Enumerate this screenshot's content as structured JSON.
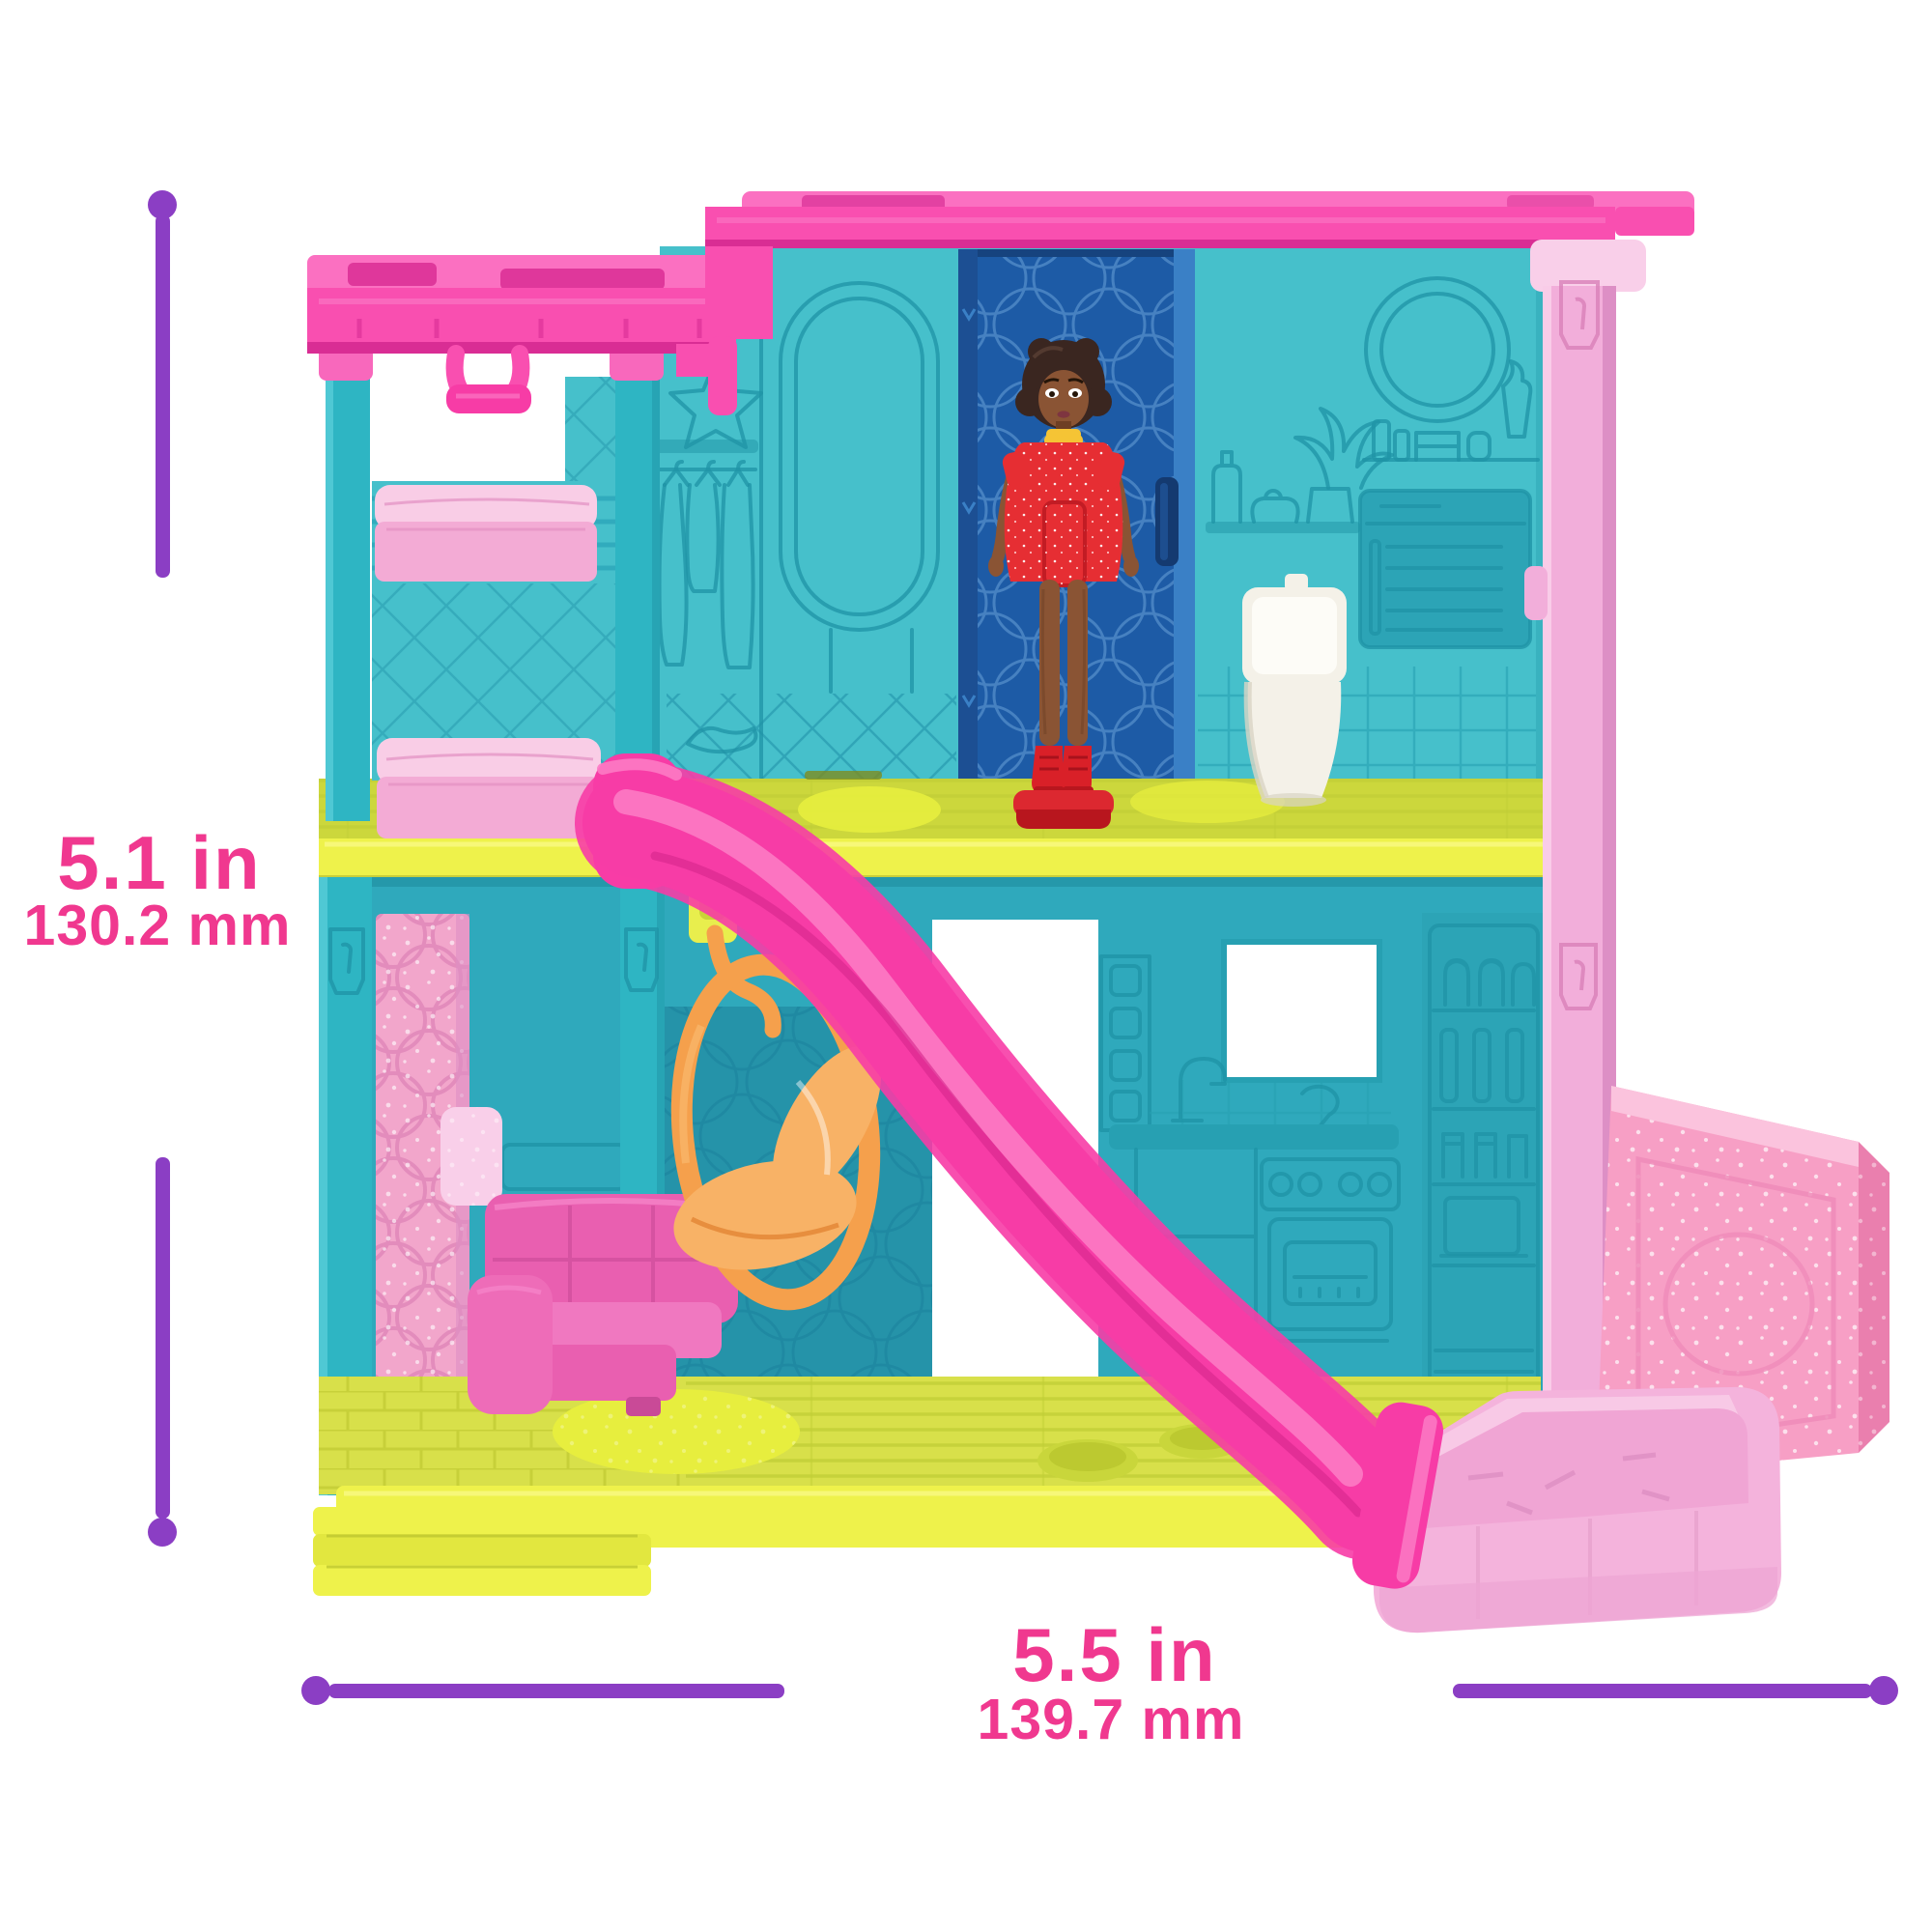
{
  "dimensions": {
    "height": {
      "inches": "5.1 in",
      "millimeters": "130.2 mm"
    },
    "width": {
      "inches": "5.5 in",
      "millimeters": "139.7 mm"
    }
  },
  "colors": {
    "background": "#ffffff",
    "dim_line": "#8b3ec4",
    "dim_text": "#f0388f",
    "roof_pink": "#f94fb0",
    "roof_pink_light": "#fb70c1",
    "roof_pink_dark": "#d92d94",
    "column_pink": "#f2aeda",
    "column_pink_light": "#f9cfe9",
    "column_pink_dark": "#dd8fc5",
    "mattress_top": "#f9cde6",
    "mattress_front": "#f3abd5",
    "glitter_pink": "#f2a6cb",
    "glitter_wall": "#f79fc5",
    "tray_pink": "#f4b3dc",
    "tray_rim": "#f8c9e6",
    "tray_inner": "#f0a5d4",
    "sofa_pink": "#e95fb0",
    "slide_pink": "#f73ca6",
    "slide_dark": "#d6248c",
    "slide_light": "#fc7ac4",
    "teal_wall2": "#46c0cb",
    "teal_wall1": "#2fa9bc",
    "teal_post": "#2eb5c3",
    "teal_dark_panel": "#2593a9",
    "teal_cabinet": "#2ca4b6",
    "teal_emboss": "#1f93a6",
    "floor_top": "#ccd73c",
    "floor_face": "#eef24b",
    "ground_top": "#d8e04a",
    "ground_rug": "#e7ee3e",
    "door_blue": "#1d5ba6",
    "door_blue_dark": "#16437e",
    "door_blue_light": "#3a80c6",
    "door_pattern": "#4a85c4",
    "handle_navy": "#143a70",
    "toilet_white": "#f4f1e8",
    "toilet_shadow": "#d9d4c4",
    "swing_orange": "#f5a04c",
    "swing_orange_light": "#f8b266",
    "swing_orange_dark": "#df7f2e",
    "doll_skin": "#8a5434",
    "doll_skin_dark": "#6e3f24",
    "doll_hair": "#3a2620",
    "dress_red": "#e62e33",
    "dress_red_dark": "#c21c24",
    "boot_red": "#d92028",
    "collar_yellow": "#f5c435",
    "hook_yellow": "#e8ee4d"
  }
}
